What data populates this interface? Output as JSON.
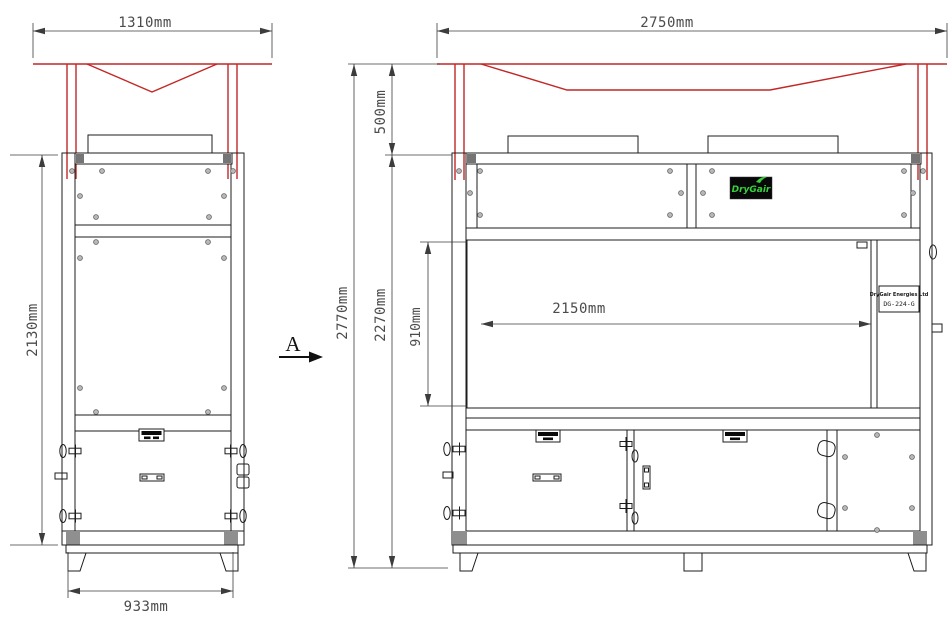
{
  "colors": {
    "line": "#1c1c1c",
    "dim_line": "#3c3c3c",
    "dim_text": "#4b4b4b",
    "red": "#c22727",
    "green": "#35d23c",
    "gray_block": "#8f8f8f",
    "bar_cap": "#757575",
    "logo_bg": "#080808"
  },
  "dimensions": {
    "front_top_width": "1310mm",
    "side_top_width": "2750mm",
    "front_cabinet_height": "2130mm",
    "front_base_width": "933mm",
    "overall_height": "2770mm",
    "canopy_height": "500mm",
    "cabinet_height": "2270mm",
    "louver_height": "910mm",
    "louver_width": "2150mm"
  },
  "labels": {
    "section_arrow": "A",
    "logo_text": "DryGair",
    "nameplate_line1": "DryGair Energies Ltd",
    "nameplate_line2": "DG-224-G"
  }
}
